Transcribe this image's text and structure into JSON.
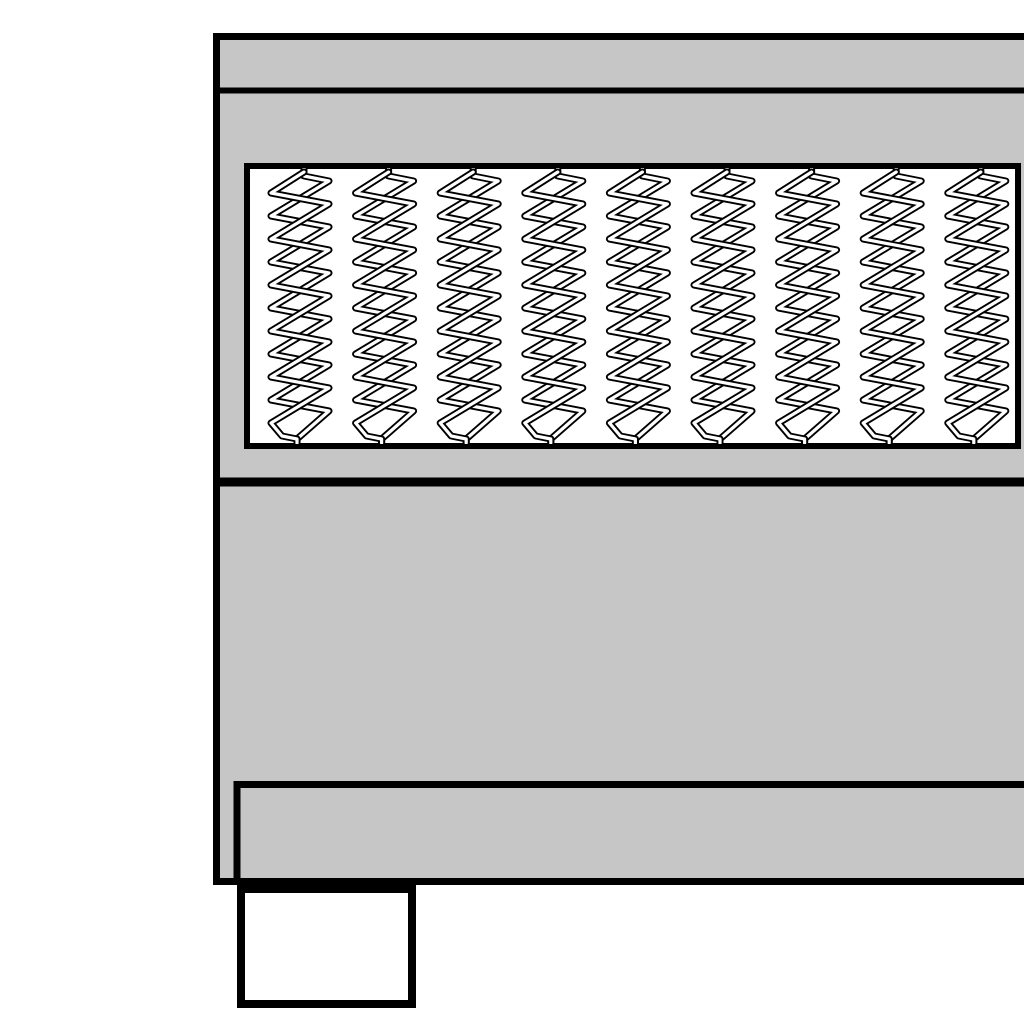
{
  "meta": {
    "title": "Box spring bed side cross-section illustration",
    "description": "Monochrome line drawing of a box spring bed edge: top mattress panel, pocket spring layer, upholstered base, plinth and one foot. Object is cropped at the right edge of the image."
  },
  "canvas": {
    "width": 1024,
    "height": 1024,
    "background": "#ffffff"
  },
  "colors": {
    "body_fill": "#c6c6c6",
    "outline": "#000000",
    "spring_area_fill": "#ffffff",
    "leg_fill": "#ffffff"
  },
  "bed": {
    "body": {
      "x": 216.5,
      "y": 36.5,
      "width": 1004,
      "height": 845,
      "stroke_width": 7
    },
    "top_panel_divider": {
      "x1": 220,
      "y1": 90.5,
      "x2": 1024,
      "y2": 90.5,
      "stroke_width": 6
    },
    "spring_box": {
      "x": 247,
      "y": 166,
      "width": 771,
      "height": 280,
      "stroke_width": 6
    },
    "mid_divider": {
      "x1": 220,
      "y1": 482,
      "x2": 1024,
      "y2": 482,
      "stroke_width": 9
    },
    "plinth": {
      "points": [
        [
          237,
          881
        ],
        [
          237,
          784.5
        ],
        [
          1024,
          784.5
        ]
      ],
      "stroke_width": 7
    },
    "leg": {
      "x": 241,
      "y": 889,
      "width": 171,
      "height": 115,
      "stroke_width": 8
    },
    "springs": {
      "count": 9,
      "first_center_x": 300,
      "spacing": 84.6,
      "half_width": 29,
      "top": 169,
      "bottom": 443,
      "first_tip_y": 181,
      "period": 46,
      "steep_drop": 35,
      "shallow_drop": 11,
      "loops": 5,
      "outline_width": 7,
      "core_width": 3.2,
      "clip": {
        "x": 250,
        "y": 168,
        "width": 765,
        "height": 276
      }
    }
  }
}
